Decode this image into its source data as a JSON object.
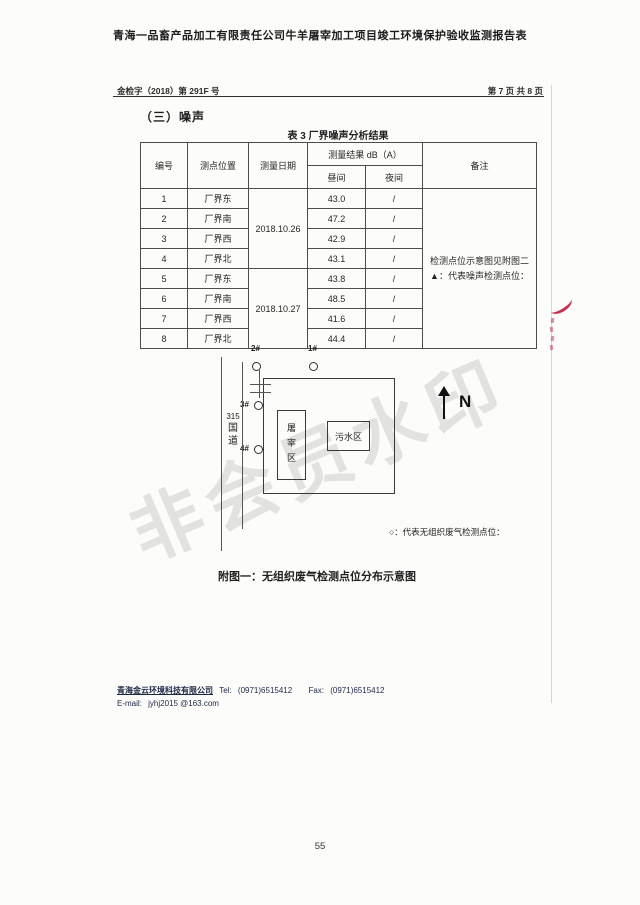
{
  "page": {
    "doc_title": "青海一品畜产品加工有限责任公司牛羊屠宰加工项目竣工环境保护验收监测报告表",
    "header_left": "金检字（2018）第 291F 号",
    "header_right": "第 7 页 共 8 页",
    "section_title": "（三）噪声",
    "page_number": "55",
    "watermark": "非会员水印"
  },
  "table": {
    "caption": "表 3  厂界噪声分析结果",
    "headers": {
      "no": "编号",
      "location": "测点位置",
      "date": "测量日期",
      "result": "测量结果 dB（A）",
      "day": "昼间",
      "night": "夜间",
      "remark": "备注"
    },
    "dates": [
      "2018.10.26",
      "2018.10.27"
    ],
    "rows": [
      {
        "no": "1",
        "location": "厂界东",
        "day": "43.0",
        "night": "/"
      },
      {
        "no": "2",
        "location": "厂界南",
        "day": "47.2",
        "night": "/"
      },
      {
        "no": "3",
        "location": "厂界西",
        "day": "42.9",
        "night": "/"
      },
      {
        "no": "4",
        "location": "厂界北",
        "day": "43.1",
        "night": "/"
      },
      {
        "no": "5",
        "location": "厂界东",
        "day": "43.8",
        "night": "/"
      },
      {
        "no": "6",
        "location": "厂界南",
        "day": "48.5",
        "night": "/"
      },
      {
        "no": "7",
        "location": "厂界西",
        "day": "41.6",
        "night": "/"
      },
      {
        "no": "8",
        "location": "厂界北",
        "day": "44.4",
        "night": "/"
      }
    ],
    "remark_line1": "检测点位示意图见附图二",
    "remark_line2": "▲：代表噪声检测点位："
  },
  "diagram": {
    "point_1": "1#",
    "point_2": "2#",
    "point_3": "3#",
    "point_4": "4#",
    "road": [
      "315",
      "国",
      "道"
    ],
    "slaughter_area": "屠宰区",
    "sewage_area": "污水区",
    "north": "N",
    "gas_legend": "○：代表无组织废气检测点位：",
    "figure_caption": "附图一：无组织废气检测点位分布示意图"
  },
  "footer": {
    "company": "青海金云环境科技有限公司",
    "tel_label": "Tel:",
    "tel": "(0971)6515412",
    "fax_label": "Fax:",
    "fax": "(0971)6515412",
    "email_label": "E-mail:",
    "email": "jyhj2015 @163.com"
  }
}
